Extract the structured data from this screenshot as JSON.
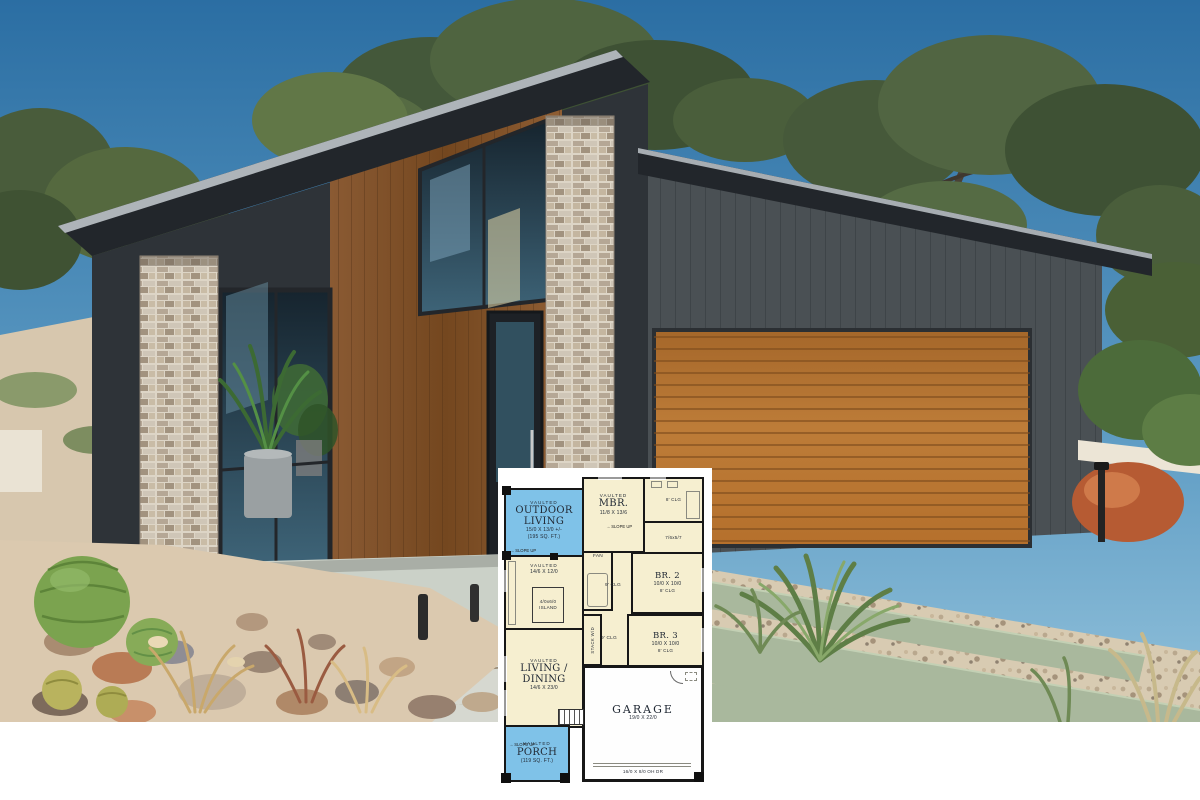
{
  "palette": {
    "sky_top": "#2b6ea3",
    "sky_bottom": "#93c2db",
    "foliage": "#4c5f3a",
    "roof": "#22262b",
    "wood_siding": "#80512c",
    "stone": "#c6bcae",
    "dark_siding": "#4a5054",
    "garage_door": "#b06f2e",
    "concrete": "#cbd1c8",
    "driveway_strip": "#a9b89d",
    "gravel": "#dbc9af",
    "cactus": "#7ba34f",
    "terracotta": "#b65b33",
    "plan_room": "#f6efd0",
    "plan_outdoor": "#7fc2e8",
    "plan_wall": "#171717"
  },
  "icons": {
    "slope_arrow": "→"
  },
  "floorplan": {
    "rooms": {
      "outdoor_living": {
        "vaulted": "VAULTED",
        "name": "OUTDOOR LIVING",
        "dims": "15/0 X 13/0 +/-",
        "area": "(195 SQ. FT.)",
        "slope": "SLOPE UP"
      },
      "mbr": {
        "vaulted": "VAULTED",
        "name": "MBR.",
        "dims": "11/8 X 13/6",
        "slope": "SLOPE UP"
      },
      "mbath": {
        "clg": "8' CLG"
      },
      "wic": {
        "dims": "7/6x5/7"
      },
      "kitchen": {
        "vaulted": "VAULTED",
        "dims": "14/6 X 12/0",
        "island": "4/0x6/0 ISLAND"
      },
      "fan": {
        "label": "FAN"
      },
      "hall_upper": {
        "clg": "9' CLG"
      },
      "hall_lower": {
        "clg": "9' CLG"
      },
      "br2": {
        "name": "BR. 2",
        "dims": "10/0 X 10/0",
        "clg": "8' CLG"
      },
      "br3": {
        "name": "BR. 3",
        "dims": "10/0 X 10/0",
        "clg": "8' CLG"
      },
      "laundry": {
        "label": "STACK W/D"
      },
      "living": {
        "vaulted": "VAULTED",
        "name": "LIVING / DINING",
        "dims": "14/6 X 23/0"
      },
      "garage": {
        "name": "GARAGE",
        "dims": "19/0 X 22/0",
        "door_label": "16/0 X 8/0 OH DR"
      },
      "porch": {
        "vaulted": "VAULTED",
        "name": "PORCH",
        "area": "(119 SQ. FT.)",
        "slope": "SLOPE UP"
      }
    }
  }
}
